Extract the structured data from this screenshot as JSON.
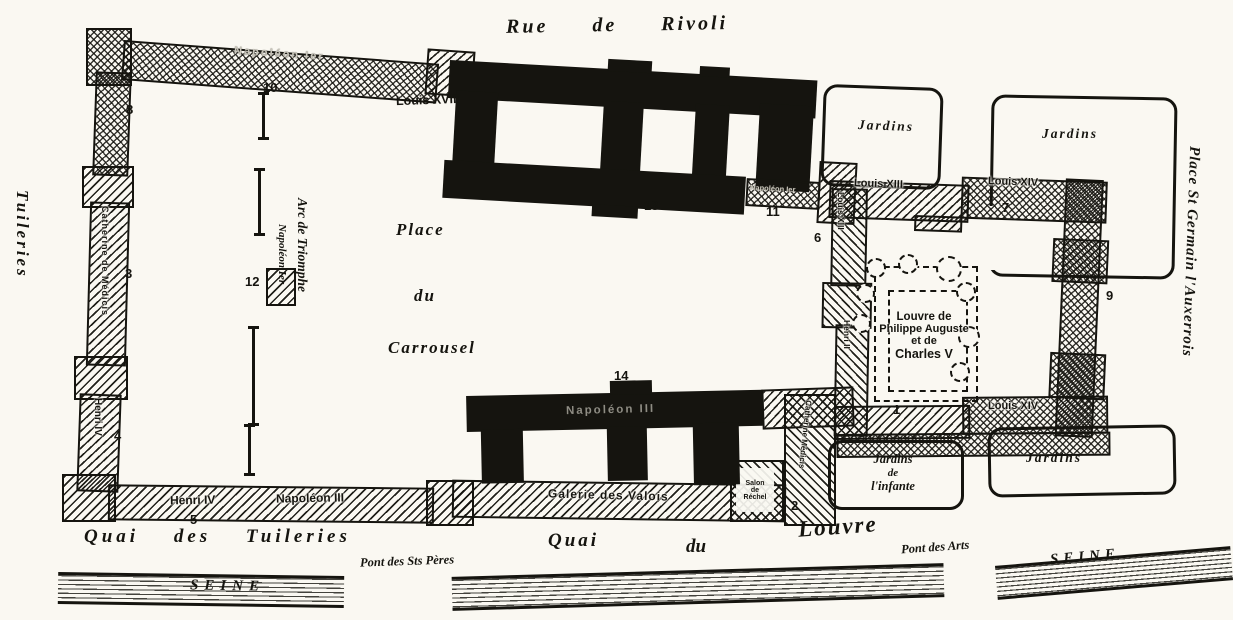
{
  "labels": {
    "rivoli": "Rue de Rivoli",
    "quai_tuileries": "Quai des Tuileries",
    "quai": "Quai",
    "du": "du",
    "louvre": "Louvre",
    "pont_peres": "Pont des Sts Pères",
    "pont_arts": "Pont des Arts",
    "seine": "SEINE",
    "tuileries": "Tuileries",
    "place": "Place",
    "carrousel": "Carrousel",
    "st_germain": "Place St Germain l'Auxerrois",
    "arc": "Arc de Triomphe",
    "nap1": "Napoléon Ier",
    "louis18": "Louis XVIII",
    "nap3": "Napoléon III",
    "louis13": "Louis XIII",
    "louis14": "Louis XIV",
    "henri2": "Henri II",
    "henri4": "Henri IV",
    "catherine": "Catherine de Médicis",
    "catherine2": "Catherine Médicis",
    "valois": "Galerie des Valois",
    "salon1": "Salon",
    "salon2": "de",
    "salon3": "Réchel",
    "med1": "Louvre de",
    "med2": "Philippe Auguste",
    "med3": "et de",
    "med4": "Charles V",
    "jardins": "Jardins",
    "inf1": "Jardins",
    "inf2": "de",
    "inf3": "l'infante"
  },
  "numbers": {
    "n1": "1",
    "n2": "2",
    "n3": "3",
    "n4": "4",
    "n5": "5",
    "n6": "6",
    "n7": "7",
    "n8": "8",
    "n9": "9",
    "n10": "10",
    "n11": "11",
    "n12": "12",
    "n13": "13",
    "n14": "14"
  },
  "colors": {
    "ink": "#15140f",
    "paper": "#faf8f2"
  }
}
